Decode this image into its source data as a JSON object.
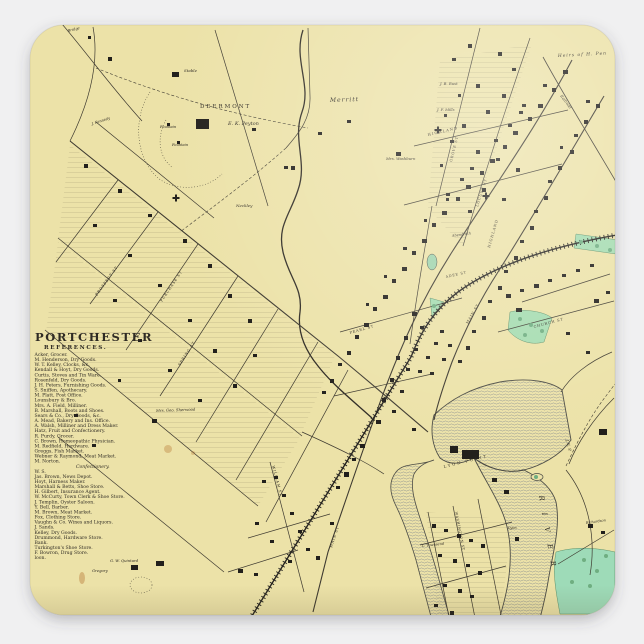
{
  "scene": {
    "type": "product-photo-of-square-sticker",
    "background_color": "#f0f0f1",
    "shadow_color": "rgba(70,70,80,0.30)"
  },
  "sticker": {
    "shape": "rounded-square",
    "x": 30,
    "y": 25,
    "width": 585,
    "height": 590,
    "corner_radius": 34
  },
  "colors": {
    "map_base": "#ece2a8",
    "map_light": "#f4ecc4",
    "ink": "#2f2b24",
    "street": "#3e3a30",
    "water_fill": "#e4e5e1",
    "water_hatch": "#8f9390",
    "shore": "#4c4c45",
    "green": "#a5dcb0",
    "green_dark": "#6fae81",
    "railroad": "#262420",
    "stain": "#b5722f"
  },
  "title_block": {
    "title": "PORTCHESTER",
    "subtitle": "REFERENCES.",
    "references": [
      "Acker, Grocer.",
      "M. Henderson, Dry Goods.",
      "W. T. Kelley, Clocks, &c.",
      "Kendall & Hoyt, Dry Goods.",
      "Curtis, Stoves and Tin Ware.",
      "Rosenfeld, Dry Goods.",
      "J. H. Peters, Furnishing Goods.",
      "S. Sniffen, Apothecary.",
      "M. Platt, Post Office.",
      "Lounsbury & Bro.",
      "Mrs. A. Field, Milliner.",
      "B. Marshall, Boots and Shoes.",
      "Sears & Co., Dry Goods, &c.",
      "A. Mead, Bakery and Ins. Office.",
      "A. Walsh, Milliner and Dress Maker.",
      "Hatz, Fruit and Confectionery.",
      "R. Purdy, Grocer.",
      "C. Brown, Homeopathic Physician.",
      "M. Redfield, Hardware.",
      "Greggs, Fish Market.",
      "Webner & Raymond, Meat Market.",
      "M. Norton.",
      "Confectionery.",
      "W. S.",
      "Jas. Brown, News Depot.",
      "Hoyt, Harness Maker.",
      "Marshall & Betts, Shoe Store.",
      "H. Gilbert, Insurance Agent.",
      "W. McCurty, Town Clerk & Shoe Store.",
      "J. Templin, Oyster Saloon.",
      "Y. Bell, Barber.",
      "M. Brown, Meat Market.",
      "Fox, Clothing Store.",
      "Vaughn & Co. Wines and Liquors.",
      "J. Sands.",
      "Kelley, Dry Goods.",
      "Drummond, Hardware Store.",
      "Bank.",
      "Turkington's Shoe Store.",
      "F. Bowron, Drug Store.",
      "loon."
    ]
  },
  "map": {
    "labels": [
      {
        "t": "DEERMONT",
        "x": 200,
        "y": 108,
        "s": 5.5,
        "ls": 2
      },
      {
        "t": "E. K. Peyton",
        "x": 228,
        "y": 125,
        "s": 5,
        "i": 1
      },
      {
        "t": "Stable",
        "x": 184,
        "y": 72,
        "s": 4,
        "i": 1
      },
      {
        "t": "Fountain",
        "x": 160,
        "y": 128,
        "s": 3.6,
        "i": 1
      },
      {
        "t": "Fountain",
        "x": 172,
        "y": 146,
        "s": 3.6,
        "i": 1
      },
      {
        "t": "Merritt",
        "x": 330,
        "y": 102,
        "s": 6,
        "r": -2,
        "ls": 1,
        "i": 1
      },
      {
        "t": "Mrs. Washburn",
        "x": 386,
        "y": 160,
        "s": 3.8,
        "i": 1
      },
      {
        "t": "J. B. Rust",
        "x": 440,
        "y": 85,
        "s": 3.8,
        "i": 1
      },
      {
        "t": "J. F. Mills",
        "x": 437,
        "y": 111,
        "s": 3.8,
        "i": 1
      },
      {
        "t": "Heirs of H. Pen",
        "x": 558,
        "y": 57,
        "s": 4.4,
        "r": -3,
        "ls": 1,
        "i": 1
      },
      {
        "t": "HIGHLAND",
        "x": 428,
        "y": 136,
        "s": 3.6,
        "r": -13,
        "ls": 1.2
      },
      {
        "t": "HIGHLAND",
        "x": 490,
        "y": 248,
        "s": 3.6,
        "r": -74,
        "ls": 1
      },
      {
        "t": "GROVE ST",
        "x": 452,
        "y": 162,
        "s": 3.6,
        "r": -76,
        "ls": 0.8
      },
      {
        "t": "LOCUST ST",
        "x": 478,
        "y": 207,
        "s": 3.6,
        "r": -72,
        "ls": 0.8
      },
      {
        "t": "MAIN ST",
        "x": 468,
        "y": 324,
        "s": 3.6,
        "r": -60,
        "ls": 0.8
      },
      {
        "t": "MAIN ST",
        "x": 332,
        "y": 548,
        "s": 3.6,
        "r": -72,
        "ls": 0.8
      },
      {
        "t": "WILLIAM ST",
        "x": 272,
        "y": 466,
        "s": 3.6,
        "r": 75,
        "ls": 0.8
      },
      {
        "t": "WASHINGTON ST",
        "x": 455,
        "y": 512,
        "s": 3.4,
        "r": 79,
        "ls": 0.6
      },
      {
        "t": "CHURCH ST",
        "x": 534,
        "y": 328,
        "s": 3.6,
        "r": -15,
        "ls": 0.8
      },
      {
        "t": "PEARL ST",
        "x": 350,
        "y": 334,
        "s": 3.6,
        "r": -16,
        "ls": 0.8
      },
      {
        "t": "ADEE ST",
        "x": 446,
        "y": 278,
        "s": 3.4,
        "r": -13,
        "ls": 0.8
      },
      {
        "t": "Abendroth",
        "x": 452,
        "y": 237,
        "s": 3.6,
        "r": -8,
        "i": 1
      },
      {
        "t": "PROSPECT ST",
        "x": 97,
        "y": 296,
        "s": 3.6,
        "r": -54,
        "ls": 0.8
      },
      {
        "t": "PURCHASE ST",
        "x": 162,
        "y": 302,
        "s": 3.6,
        "r": -56,
        "ls": 0.8
      },
      {
        "t": "SPRING ST",
        "x": 180,
        "y": 366,
        "s": 3.6,
        "r": -57,
        "ls": 0.8
      },
      {
        "t": "LYON POINT",
        "x": 444,
        "y": 468,
        "s": 3.8,
        "r": -14,
        "ls": 2
      },
      {
        "t": "RIVER",
        "x": 539,
        "y": 496,
        "s": 7,
        "r": 80,
        "ls": 12,
        "i": 1
      },
      {
        "t": "J. E. P.",
        "x": 566,
        "y": 440,
        "s": 3.8,
        "r": 76,
        "i": 1
      },
      {
        "t": "Railroad",
        "x": 560,
        "y": 96,
        "s": 3.8,
        "r": 53,
        "i": 1
      },
      {
        "t": "L. Townsend",
        "x": 422,
        "y": 547,
        "s": 3.5,
        "r": -6,
        "i": 1
      },
      {
        "t": "Lyon",
        "x": 508,
        "y": 529,
        "s": 3.5,
        "i": 1
      },
      {
        "t": "Richardson",
        "x": 586,
        "y": 524,
        "s": 3.5,
        "r": -8,
        "i": 1
      },
      {
        "t": "G. W. Quintard",
        "x": 110,
        "y": 562,
        "s": 3.8,
        "i": 1
      },
      {
        "t": "Gregory",
        "x": 92,
        "y": 572,
        "s": 3.8,
        "i": 1
      },
      {
        "t": "J. Kennedy",
        "x": 92,
        "y": 125,
        "s": 3.6,
        "r": -18,
        "i": 1
      },
      {
        "t": "Bridge",
        "x": 68,
        "y": 32,
        "s": 3.6,
        "r": -14,
        "i": 1
      },
      {
        "t": "Neckley",
        "x": 236,
        "y": 207,
        "s": 4,
        "i": 1
      },
      {
        "t": "Mrs. Geo. Sherwood",
        "x": 156,
        "y": 412,
        "s": 3.8,
        "r": -2,
        "i": 1
      }
    ],
    "buildings": [
      [
        563,
        70,
        5,
        4
      ],
      [
        552,
        88,
        4,
        4
      ],
      [
        543,
        84,
        4,
        3
      ],
      [
        538,
        104,
        5,
        4
      ],
      [
        528,
        117,
        4,
        4
      ],
      [
        519,
        111,
        4,
        3
      ],
      [
        513,
        131,
        5,
        4
      ],
      [
        503,
        145,
        4,
        4
      ],
      [
        494,
        139,
        4,
        3
      ],
      [
        490,
        159,
        5,
        4
      ],
      [
        480,
        171,
        4,
        4
      ],
      [
        470,
        167,
        4,
        3
      ],
      [
        466,
        185,
        5,
        4
      ],
      [
        456,
        197,
        4,
        4
      ],
      [
        446,
        193,
        4,
        3
      ],
      [
        442,
        211,
        5,
        4
      ],
      [
        432,
        223,
        4,
        4
      ],
      [
        424,
        219,
        3,
        3
      ],
      [
        422,
        239,
        5,
        4
      ],
      [
        412,
        251,
        4,
        4
      ],
      [
        403,
        247,
        4,
        3
      ],
      [
        402,
        267,
        5,
        4
      ],
      [
        392,
        279,
        4,
        4
      ],
      [
        384,
        275,
        3,
        3
      ],
      [
        383,
        295,
        5,
        4
      ],
      [
        373,
        307,
        4,
        4
      ],
      [
        366,
        303,
        3,
        3
      ],
      [
        364,
        323,
        5,
        4
      ],
      [
        355,
        335,
        4,
        4
      ],
      [
        347,
        351,
        4,
        4
      ],
      [
        338,
        363,
        4,
        3
      ],
      [
        330,
        379,
        4,
        4
      ],
      [
        322,
        391,
        4,
        3
      ],
      [
        596,
        104,
        4,
        4
      ],
      [
        586,
        100,
        4,
        3
      ],
      [
        584,
        120,
        4,
        4
      ],
      [
        574,
        134,
        4,
        3
      ],
      [
        570,
        150,
        4,
        4
      ],
      [
        560,
        146,
        3,
        3
      ],
      [
        558,
        166,
        4,
        4
      ],
      [
        548,
        180,
        4,
        3
      ],
      [
        544,
        196,
        4,
        4
      ],
      [
        534,
        210,
        4,
        3
      ],
      [
        530,
        226,
        4,
        4
      ],
      [
        520,
        240,
        4,
        3
      ],
      [
        514,
        256,
        4,
        4
      ],
      [
        504,
        270,
        4,
        3
      ],
      [
        498,
        286,
        4,
        4
      ],
      [
        488,
        300,
        4,
        3
      ],
      [
        482,
        316,
        4,
        4
      ],
      [
        472,
        330,
        4,
        3
      ],
      [
        466,
        346,
        4,
        4
      ],
      [
        458,
        360,
        4,
        3
      ],
      [
        468,
        44,
        4,
        4
      ],
      [
        452,
        58,
        4,
        3
      ],
      [
        498,
        52,
        4,
        4
      ],
      [
        512,
        68,
        4,
        3
      ],
      [
        476,
        84,
        4,
        4
      ],
      [
        458,
        94,
        3,
        3
      ],
      [
        502,
        94,
        4,
        4
      ],
      [
        522,
        104,
        4,
        3
      ],
      [
        486,
        110,
        4,
        4
      ],
      [
        444,
        114,
        3,
        3
      ],
      [
        462,
        124,
        4,
        4
      ],
      [
        508,
        124,
        4,
        3
      ],
      [
        450,
        140,
        4,
        3
      ],
      [
        476,
        150,
        4,
        4
      ],
      [
        496,
        158,
        4,
        3
      ],
      [
        440,
        164,
        3,
        3
      ],
      [
        516,
        168,
        4,
        4
      ],
      [
        460,
        178,
        4,
        3
      ],
      [
        482,
        188,
        4,
        4
      ],
      [
        446,
        198,
        3,
        3
      ],
      [
        502,
        198,
        4,
        3
      ],
      [
        468,
        210,
        4,
        3
      ],
      [
        84,
        164,
        4,
        4
      ],
      [
        118,
        189,
        4,
        4
      ],
      [
        148,
        214,
        4,
        3
      ],
      [
        93,
        224,
        4,
        3
      ],
      [
        183,
        239,
        4,
        4
      ],
      [
        128,
        254,
        4,
        3
      ],
      [
        208,
        264,
        4,
        4
      ],
      [
        158,
        284,
        4,
        3
      ],
      [
        113,
        299,
        4,
        3
      ],
      [
        228,
        294,
        4,
        4
      ],
      [
        188,
        319,
        4,
        3
      ],
      [
        248,
        319,
        4,
        4
      ],
      [
        138,
        339,
        4,
        3
      ],
      [
        213,
        349,
        4,
        4
      ],
      [
        168,
        369,
        4,
        3
      ],
      [
        253,
        354,
        4,
        3
      ],
      [
        233,
        384,
        4,
        4
      ],
      [
        198,
        399,
        4,
        3
      ],
      [
        118,
        379,
        3,
        3
      ],
      [
        152,
        419,
        5,
        4
      ],
      [
        74,
        414,
        4,
        3
      ],
      [
        92,
        444,
        4,
        3
      ],
      [
        196,
        119,
        13,
        10
      ],
      [
        172,
        72,
        7,
        5
      ],
      [
        167,
        123,
        3,
        3
      ],
      [
        177,
        141,
        3,
        3
      ],
      [
        291,
        166,
        4,
        4
      ],
      [
        396,
        152,
        5,
        4
      ],
      [
        347,
        120,
        4,
        3
      ],
      [
        108,
        57,
        4,
        4
      ],
      [
        88,
        36,
        3,
        3
      ],
      [
        284,
        166,
        4,
        3
      ],
      [
        252,
        128,
        4,
        3
      ],
      [
        318,
        132,
        4,
        3
      ],
      [
        412,
        312,
        5,
        4
      ],
      [
        420,
        326,
        4,
        3
      ],
      [
        404,
        336,
        4,
        4
      ],
      [
        414,
        348,
        4,
        3
      ],
      [
        396,
        356,
        4,
        4
      ],
      [
        406,
        368,
        4,
        3
      ],
      [
        390,
        378,
        4,
        4
      ],
      [
        400,
        390,
        4,
        3
      ],
      [
        382,
        398,
        4,
        4
      ],
      [
        392,
        410,
        4,
        3
      ],
      [
        376,
        420,
        5,
        4
      ],
      [
        418,
        370,
        4,
        3
      ],
      [
        426,
        356,
        4,
        3
      ],
      [
        434,
        342,
        4,
        3
      ],
      [
        440,
        330,
        4,
        3
      ],
      [
        448,
        344,
        4,
        3
      ],
      [
        442,
        358,
        4,
        3
      ],
      [
        430,
        372,
        4,
        3
      ],
      [
        412,
        428,
        4,
        3
      ],
      [
        432,
        524,
        4,
        4
      ],
      [
        444,
        529,
        4,
        3
      ],
      [
        457,
        534,
        4,
        4
      ],
      [
        469,
        539,
        4,
        3
      ],
      [
        481,
        544,
        4,
        4
      ],
      [
        438,
        554,
        4,
        3
      ],
      [
        453,
        559,
        4,
        4
      ],
      [
        466,
        564,
        4,
        3
      ],
      [
        478,
        571,
        4,
        4
      ],
      [
        443,
        584,
        4,
        3
      ],
      [
        458,
        589,
        4,
        4
      ],
      [
        470,
        595,
        4,
        3
      ],
      [
        434,
        604,
        4,
        3
      ],
      [
        450,
        611,
        4,
        4
      ],
      [
        463,
        617,
        4,
        3
      ],
      [
        462,
        450,
        17,
        9
      ],
      [
        450,
        446,
        8,
        7
      ],
      [
        492,
        478,
        5,
        4
      ],
      [
        504,
        490,
        5,
        4
      ],
      [
        515,
        537,
        4,
        4
      ],
      [
        316,
        556,
        4,
        4
      ],
      [
        306,
        548,
        4,
        3
      ],
      [
        298,
        530,
        4,
        3
      ],
      [
        290,
        512,
        4,
        3
      ],
      [
        282,
        494,
        4,
        3
      ],
      [
        274,
        476,
        4,
        3
      ],
      [
        262,
        480,
        4,
        3
      ],
      [
        288,
        560,
        4,
        3
      ],
      [
        270,
        540,
        4,
        3
      ],
      [
        255,
        522,
        4,
        3
      ],
      [
        330,
        522,
        4,
        3
      ],
      [
        360,
        444,
        5,
        4
      ],
      [
        352,
        458,
        4,
        3
      ],
      [
        344,
        472,
        5,
        5
      ],
      [
        336,
        486,
        4,
        3
      ],
      [
        131,
        565,
        7,
        5
      ],
      [
        156,
        561,
        8,
        5
      ],
      [
        238,
        569,
        5,
        4
      ],
      [
        254,
        573,
        4,
        3
      ],
      [
        594,
        299,
        5,
        4
      ],
      [
        606,
        291,
        4,
        3
      ],
      [
        586,
        351,
        4,
        3
      ],
      [
        599,
        429,
        8,
        6
      ],
      [
        588,
        524,
        5,
        4
      ],
      [
        601,
        531,
        4,
        3
      ],
      [
        566,
        332,
        4,
        3
      ],
      [
        506,
        294,
        5,
        4
      ],
      [
        520,
        289,
        4,
        3
      ],
      [
        534,
        284,
        5,
        4
      ],
      [
        548,
        279,
        4,
        3
      ],
      [
        562,
        274,
        4,
        3
      ],
      [
        576,
        269,
        4,
        3
      ],
      [
        590,
        264,
        4,
        3
      ],
      [
        516,
        308,
        6,
        4
      ]
    ],
    "churches": [
      [
        486,
        196
      ],
      [
        176,
        198
      ],
      [
        438,
        130
      ]
    ],
    "trees": [
      [
        520,
        319
      ],
      [
        531,
        325
      ],
      [
        542,
        331
      ],
      [
        525,
        335
      ],
      [
        536,
        477
      ],
      [
        584,
        560
      ],
      [
        597,
        571
      ],
      [
        572,
        582
      ],
      [
        606,
        556
      ],
      [
        590,
        586
      ],
      [
        581,
        242
      ],
      [
        597,
        246
      ],
      [
        610,
        250
      ],
      [
        434,
        306
      ]
    ]
  }
}
